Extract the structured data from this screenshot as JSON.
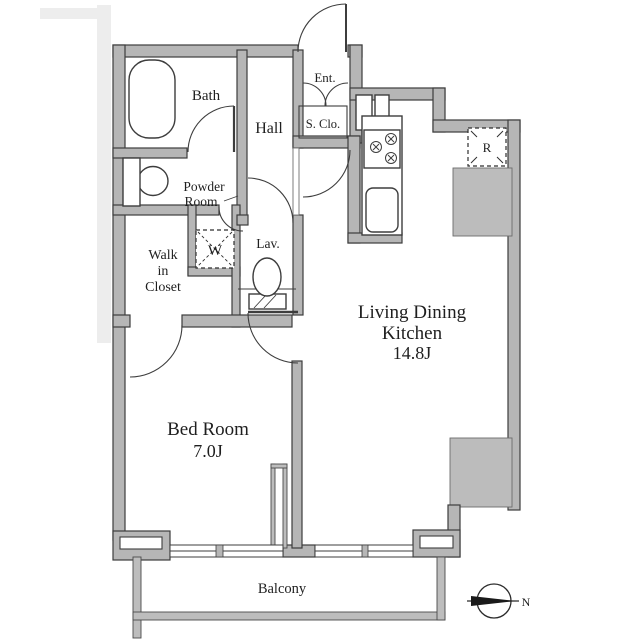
{
  "plan": {
    "rooms": {
      "bath": "Bath",
      "powder_line1": "Powder",
      "powder_line2": "Room",
      "hall": "Hall",
      "ent": "Ent.",
      "shoe_closet": "S. Clo.",
      "wic_line1": "Walk",
      "wic_line2": "in",
      "wic_line3": "Closet",
      "lav": "Lav.",
      "washer_mark": "W",
      "fridge_mark": "R",
      "ldk_line1": "Living Dining",
      "ldk_line2": "Kitchen",
      "ldk_area": "14.8J",
      "bedroom_line1": "Bed Room",
      "bedroom_area": "7.0J",
      "balcony": "Balcony"
    },
    "compass": {
      "north_label": "N"
    },
    "colors": {
      "wall_fill": "#b6b6b6",
      "wall_stroke": "#3d3d3d",
      "column_fill": "#bcbcbc",
      "background": "#ffffff",
      "text": "#1f1f1f"
    }
  }
}
